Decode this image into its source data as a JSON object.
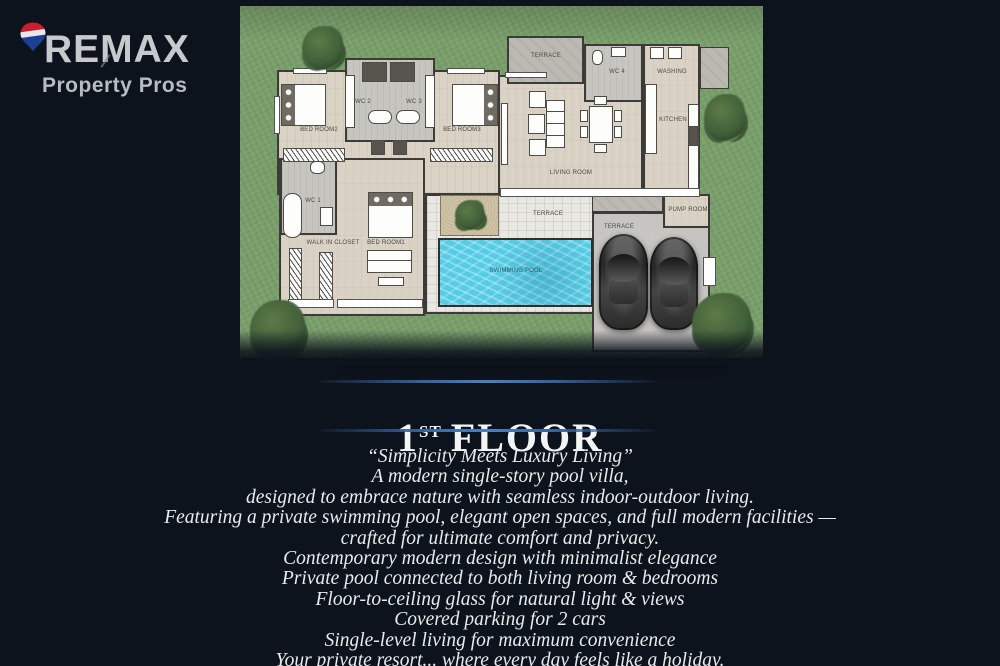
{
  "logo": {
    "brand": "REMAX",
    "tagline": "Property Pros",
    "balloon_colors": {
      "top": "#c8202f",
      "middle": "#e8e8ea",
      "bottom": "#1d3f93"
    }
  },
  "floorplan": {
    "labels": {
      "terrace_top": "TERRACE",
      "wc4": "WC 4",
      "washing": "WASHING",
      "kitchen": "KITCHEN",
      "living_room": "LIVING ROOM",
      "bedroom2": "BED ROOM2",
      "wc2": "WC 2",
      "wc3": "WC 3",
      "bedroom3": "BED ROOM3",
      "wc1": "WC 1",
      "walk_in_closet": "WALK IN CLOSET",
      "bedroom1": "BED ROOM1",
      "terrace_pool": "TERRACE",
      "swimming_pool": "SWIMMING POOL",
      "terrace_parking": "TERRACE",
      "pump_room": "PUMP ROOM"
    }
  },
  "title": {
    "number": "1",
    "ordinal": "ST",
    "word": "FLOOR"
  },
  "description": {
    "lines": [
      "“Simplicity Meets Luxury Living”",
      "A modern single-story pool villa,",
      "designed to embrace nature with seamless indoor-outdoor living.",
      "Featuring a private swimming pool, elegant open spaces, and full modern facilities —",
      "crafted for ultimate comfort and privacy.",
      "Contemporary modern design with minimalist elegance",
      "Private pool connected to both living room & bedrooms",
      "Floor-to-ceiling glass for natural light & views",
      "Covered parking for 2 cars",
      "Single-level living for maximum convenience",
      "Your private resort... where every day feels like a holiday."
    ]
  },
  "colors": {
    "background": "#0d131c",
    "grass": "#7ca26d",
    "pool_water": "#55cce6",
    "accent_line_blue": "#4d7fc4",
    "title_text": "#f3f4f6",
    "body_text": "#e8eaec"
  }
}
